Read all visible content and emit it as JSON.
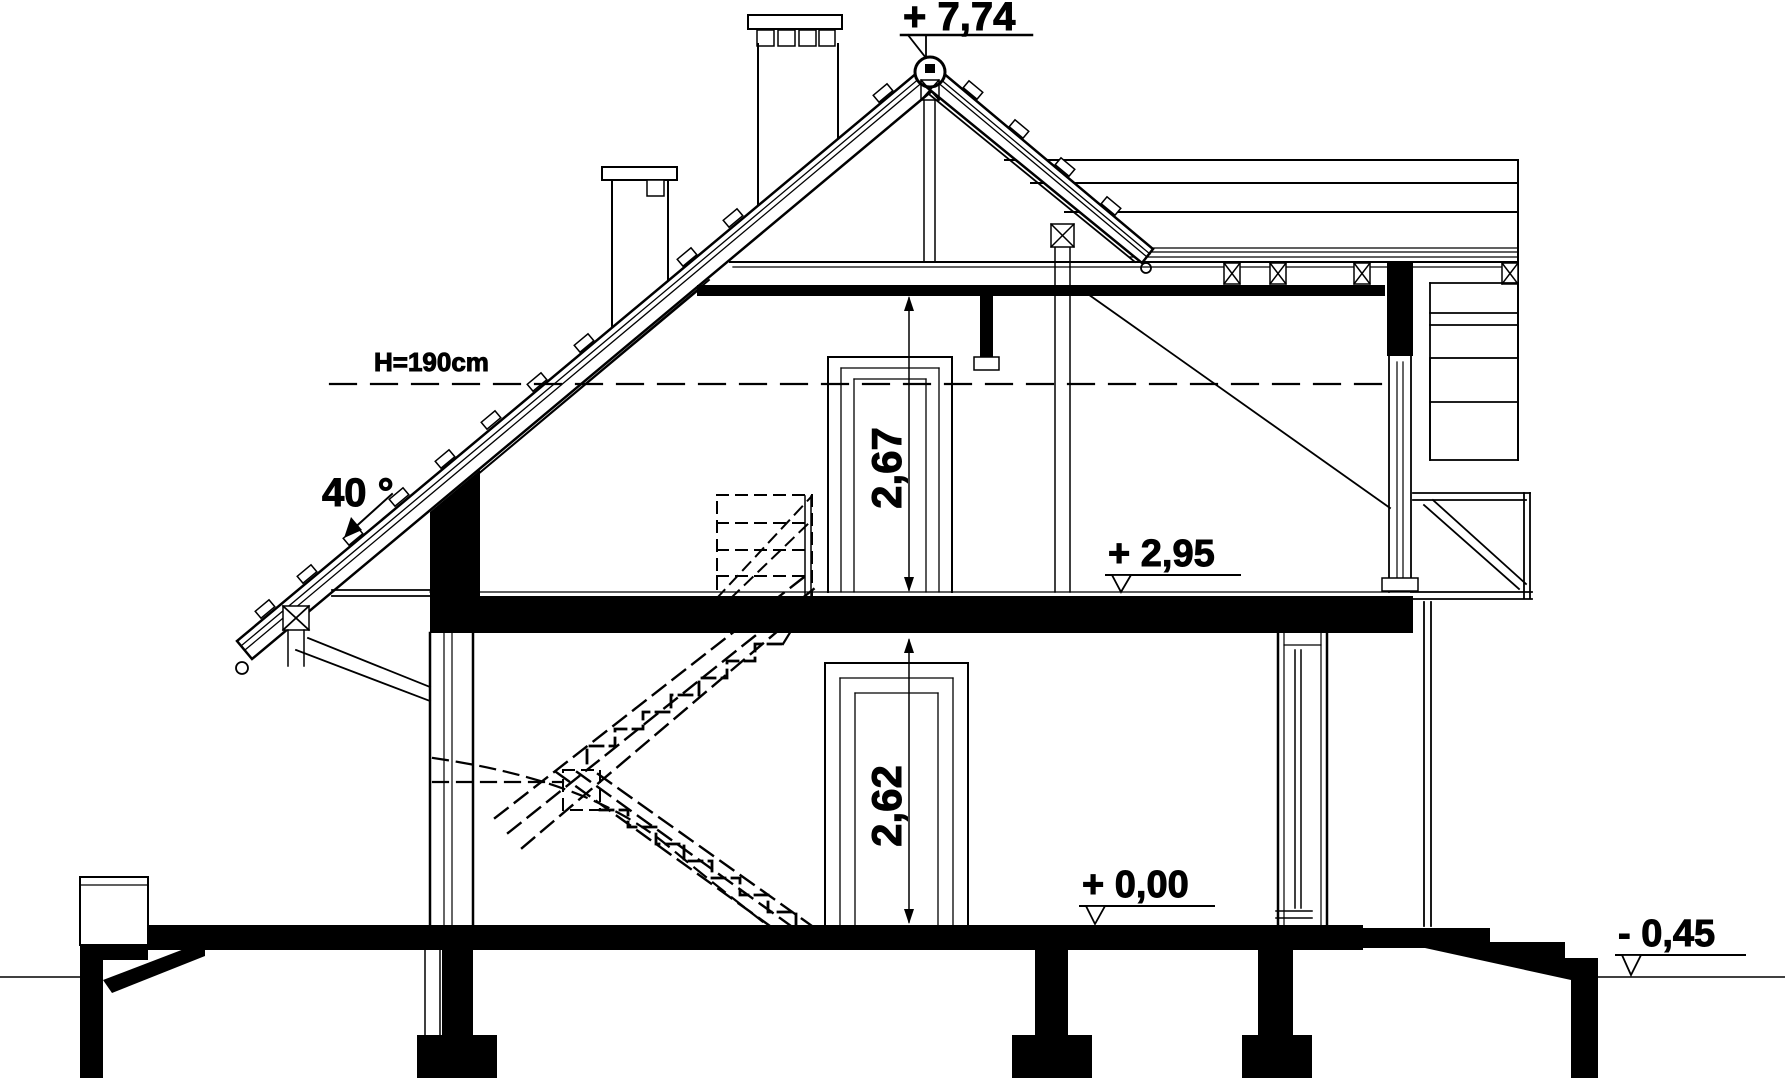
{
  "drawing": {
    "type": "architectural-cross-section",
    "labels": {
      "ridge_level": "+ 7,74",
      "headroom": "H=190cm",
      "roof_angle": "40 °",
      "attic_room_height": "2,67",
      "ground_room_height": "2,62",
      "first_floor_level": "+ 2,95",
      "ground_floor_level": "+ 0,00",
      "terrain_level": "- 0,45"
    },
    "colors": {
      "ink": "#000000",
      "paper": "#ffffff"
    }
  }
}
